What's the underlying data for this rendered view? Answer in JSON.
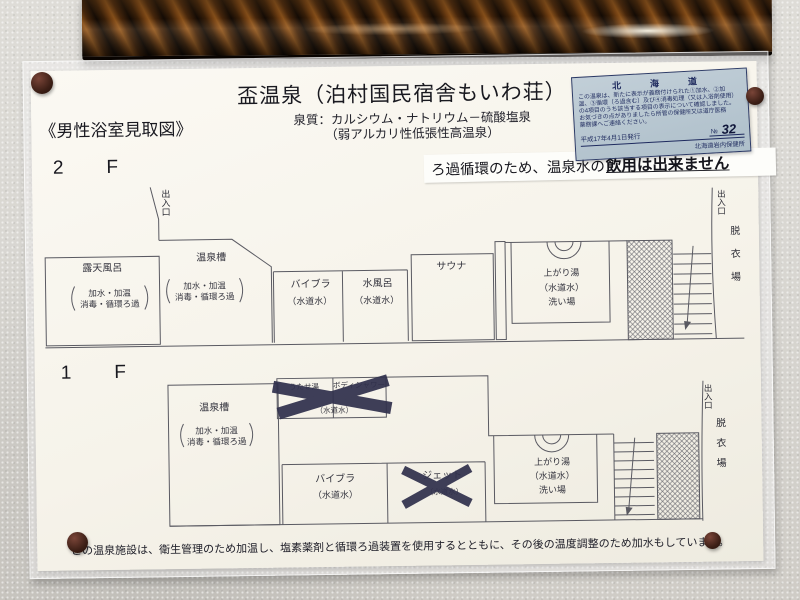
{
  "poster": {
    "title": "盃温泉（泊村国民宿舎もいわ荘）",
    "spring_quality_line1": "泉質：カルシウム・ナトリウム－硫酸塩泉",
    "spring_quality_line2": "（弱アルカリ性低張性高温泉）",
    "map_title": "《男性浴室見取図》",
    "footer_note": "この温泉施設は、衛生管理のため加温し、塩素薬剤と循環ろ過装置を使用するとともに、その後の温度調整のため加水もしています。"
  },
  "notice_banner": {
    "prefix": "ろ過循環のため、温泉水の",
    "emphasis": "飲用は出来ません"
  },
  "certificate": {
    "region": "北　海　道",
    "body_line1": "この温泉は、新たに表示が義務付けられた①加水、②加",
    "body_line2": "温、③循環（ろ過含む）及び④消毒処理（又は入浴剤使用）",
    "body_line3": "の4項目のうち該当する項目の表示について確認しました。",
    "body_line4": "お気づきの点がありましたら所管の保健所又は道庁医務",
    "body_line5": "薬務課へご連絡ください。",
    "issue_date": "平成17年4月1日発行",
    "number_label": "№",
    "number": "32",
    "office": "北海道岩内保健所"
  },
  "floor2": {
    "label": "2　F",
    "entrance_left": "出入口",
    "rotenburo": {
      "name": "露天風呂",
      "treat1": "加水・加温",
      "treat2": "消毒・循環ろ過"
    },
    "onsenso": {
      "name": "温泉槽",
      "treat1": "加水・加温",
      "treat2": "消毒・循環ろ過"
    },
    "vibra": {
      "name": "バイブラ",
      "water": "（水道水）"
    },
    "mizuburo": {
      "name": "水風呂",
      "water": "（水道水）"
    },
    "sauna": {
      "name": "サウナ"
    },
    "agariyu": {
      "name": "上がり湯",
      "water": "（水道水）",
      "washing": "洗い場"
    },
    "entrance_right": "出入口",
    "dressing_room": "脱衣場"
  },
  "floor1": {
    "label": "1　F",
    "onsenso": {
      "name": "温泉槽",
      "treat1": "加水・加温",
      "treat2": "消毒・循環ろ過"
    },
    "utaseyu": {
      "name": "うたせ湯",
      "water": "（水道水）"
    },
    "body_shower": {
      "name": "ボディシャワー"
    },
    "vibra": {
      "name": "バイブラ",
      "water": "（水道水）"
    },
    "jet": {
      "name": "ジェット",
      "water": "（水道水）"
    },
    "agariyu": {
      "name": "上がり湯",
      "water": "（水道水）",
      "washing": "洗い場"
    },
    "entrance_right": "出入口",
    "dressing_room": "脱衣場"
  },
  "colors": {
    "wall": "#d7d5d0",
    "poster_paper": "#f7f5ee",
    "certificate_bg": "#b9c6d0",
    "certificate_ink": "#1e2a5e",
    "tape_x": "#31314d",
    "pushpin": "#4a2318",
    "plan_line": "#5a5a62",
    "frame_dark": "#1a0d05",
    "frame_highlight": "#8a5018"
  }
}
